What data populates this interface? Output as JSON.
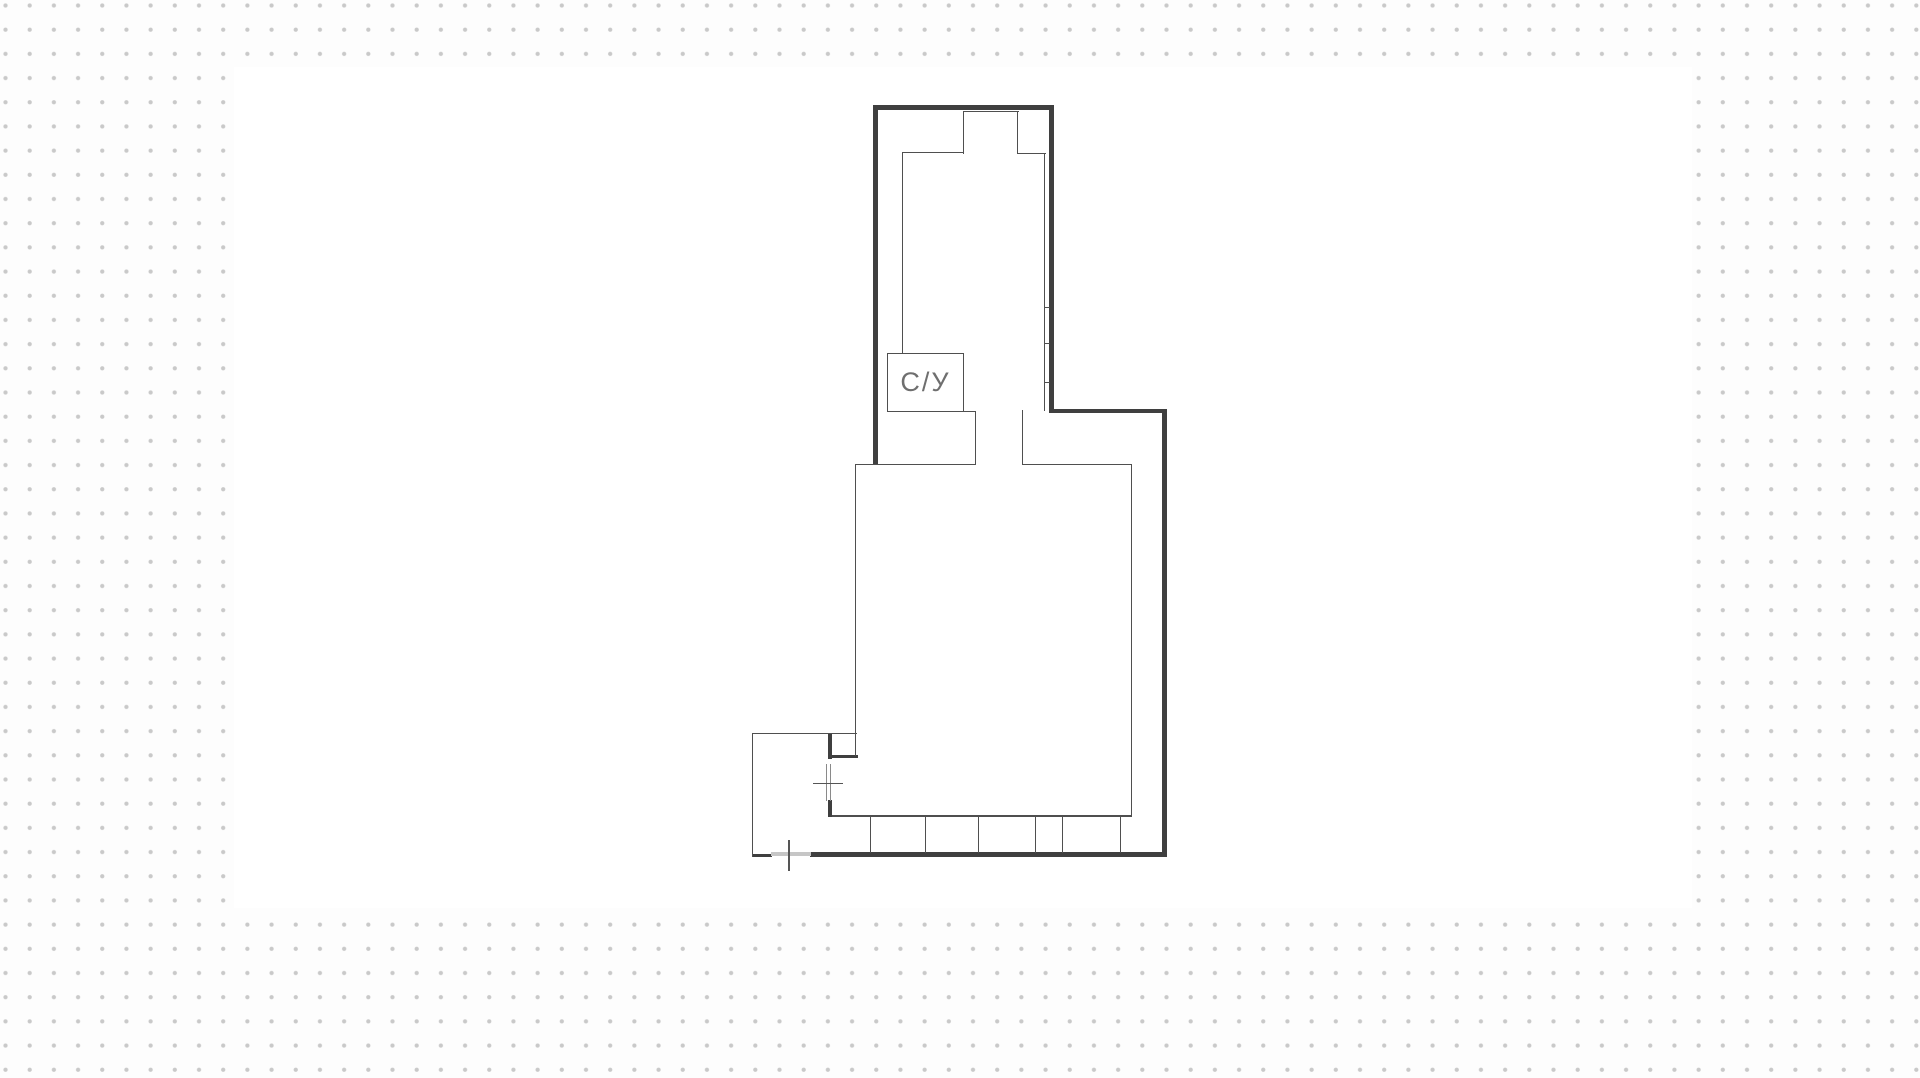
{
  "canvas": {
    "outer_background": "#fdfdfd",
    "inner_background": "#ffffff",
    "dot_color": "#c9c9c9"
  },
  "floor_plan": {
    "colors": {
      "wall": "#3f3f3f",
      "line": "#4f4f4f",
      "door": "#8a8a8a",
      "axis": "#555555",
      "light": "#c6c6c6",
      "label_text": "#6f6f6f"
    },
    "labels": {
      "bathroom": "С/У"
    }
  }
}
